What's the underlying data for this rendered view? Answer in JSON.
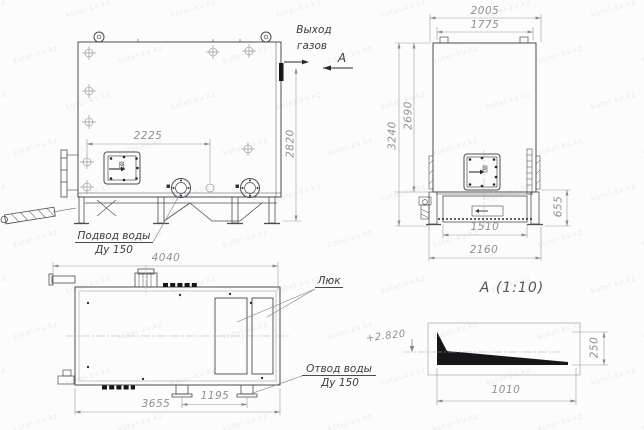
{
  "watermark": "kotel-kv.kz",
  "labels": {
    "gas_outlet_line1": "Выход",
    "gas_outlet_line2": "газов",
    "section_letter": "А",
    "water_supply_line1": "Подвод воды",
    "water_supply_line2": "Ду 150",
    "hatch": "Люк",
    "water_drain_line1": "Отвод воды",
    "water_drain_line2": "Ду 150",
    "detail_title": "А (1:10)",
    "elevation_mark": "+2.820"
  },
  "dims": {
    "side": {
      "width": "2225",
      "height": "2820"
    },
    "front": {
      "outer_width": "2005",
      "inner_width": "1775",
      "total_height": "3240",
      "body_height": "2690",
      "base_height": "655",
      "base_inner_width": "1510",
      "base_outer_width": "2160"
    },
    "plan": {
      "overall_length": "4040",
      "body_length": "3655",
      "drain_spacing": "1195"
    },
    "detail": {
      "height": "250",
      "length": "1010"
    }
  }
}
